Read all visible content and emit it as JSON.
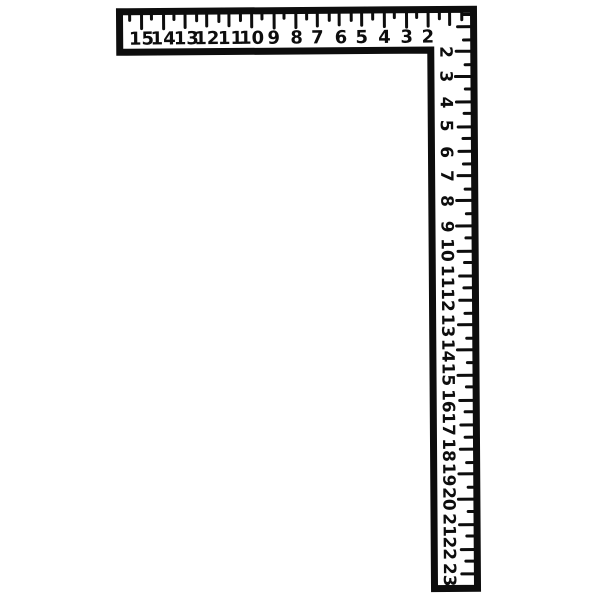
{
  "figure": {
    "title": "carpenter framing square",
    "style": "hand-drawn black line art on white",
    "colors": {
      "ink": "#0d0d0d",
      "background": "#ffffff"
    },
    "blade": {
      "orientation": "horizontal, along top, numbers read left to right",
      "ticks_edge": "top edge, long tick each inch, short tick each half inch",
      "numbers": [
        "15",
        "14",
        "13",
        "12",
        "11",
        "10",
        "9",
        "8",
        "7",
        "6",
        "5",
        "4",
        "3",
        "2"
      ]
    },
    "tongue": {
      "orientation": "vertical, along right side, numbers read top to bottom",
      "number_rotation_deg": 90,
      "ticks_edge": "right edge, long tick each inch, short tick each half inch",
      "numbers": [
        "2",
        "3",
        "4",
        "5",
        "6",
        "7",
        "8",
        "9",
        "10",
        "11",
        "12",
        "13",
        "14",
        "15",
        "16",
        "17",
        "18",
        "19",
        "20",
        "21",
        "22",
        "23"
      ]
    }
  }
}
